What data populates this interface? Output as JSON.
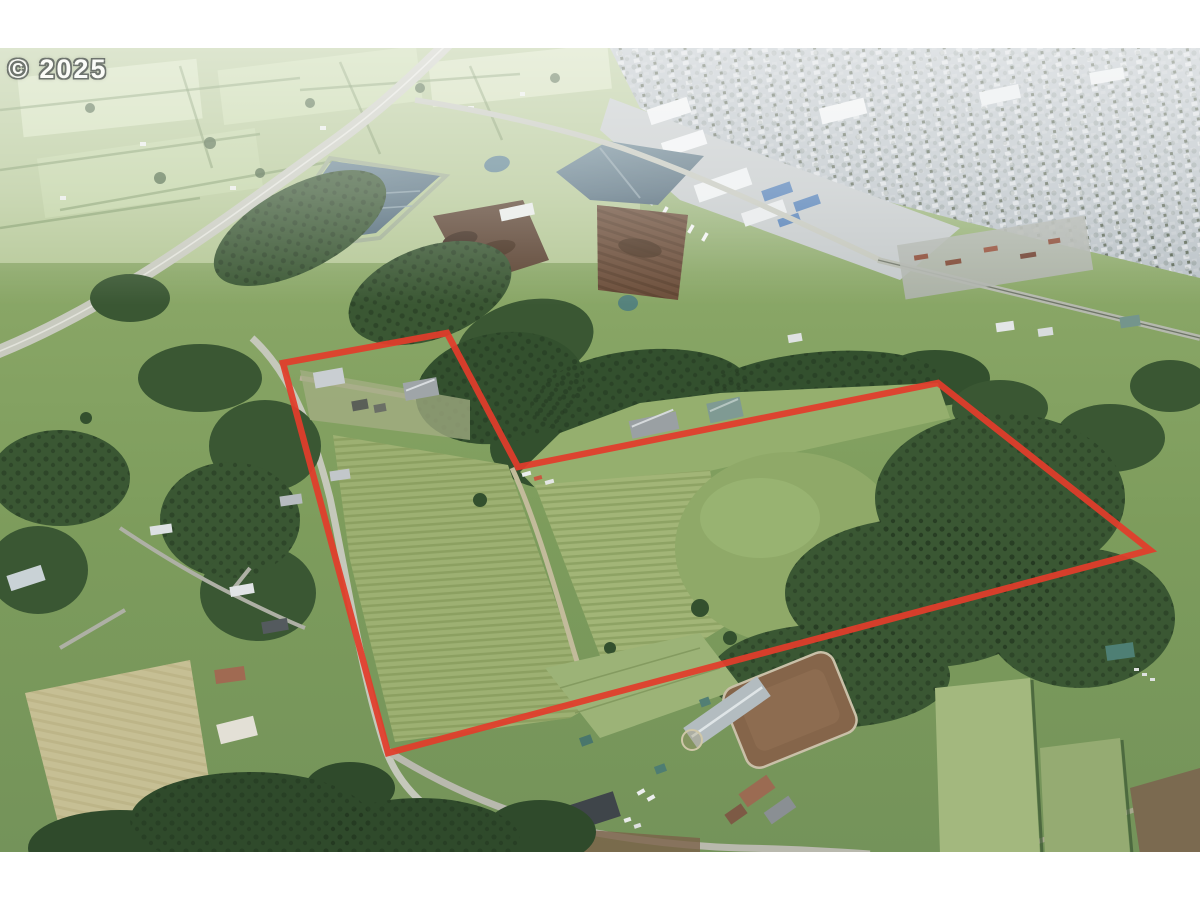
{
  "image": {
    "kind": "aerial-property-listing-photo",
    "watermark_text": "© 2025",
    "description": "Aerial drone photo of rural acreage with red property boundary outline; town and highway in distance, vineyard rows, forest, farms"
  },
  "overlay": {
    "boundary_color": "#e23c2b",
    "boundary_stroke_width": "6.5",
    "boundary_points": "283,315 447,285 518,419 938,335 1150,502 388,705"
  },
  "palette": {
    "letterbox": "#ffffff",
    "grass_base": "#86a161",
    "grass_light": "#9cb479",
    "haze_field": "#c3d3ab",
    "forest_dark": "#2f4a2b",
    "forest_mid": "#3a5733",
    "pond_water": "#5d7888",
    "town_gray": "#b9c1c6",
    "road_gray": "#c6c9bd",
    "dirt_brown": "#6a4c38",
    "arena_brown": "#85654a",
    "hay_tan": "#c6bf94",
    "watermark_white": "#fbfcf8"
  }
}
